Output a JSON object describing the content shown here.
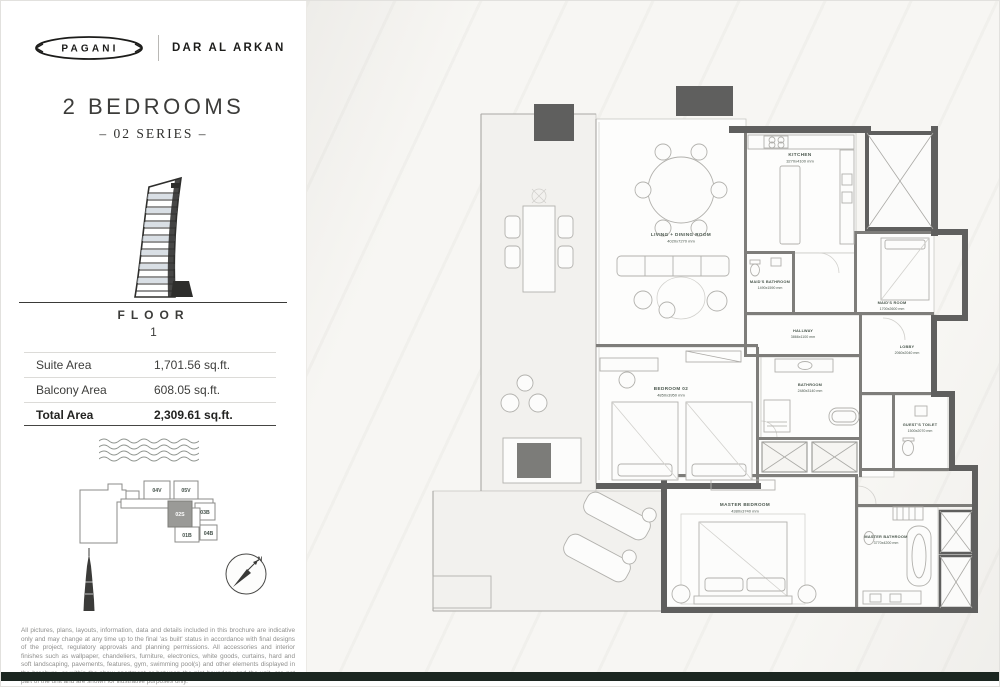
{
  "brand": {
    "logo": "PAGANI",
    "partner": "DAR AL ARKAN"
  },
  "header": {
    "title": "2 BEDROOMS",
    "subtitle": "– 02 SERIES –"
  },
  "floor": {
    "label": "FLOOR",
    "number": "1"
  },
  "areas": {
    "rows": [
      {
        "label": "Suite Area",
        "value": "1,701.56 sq.ft."
      },
      {
        "label": "Balcony Area",
        "value": "608.05 sq.ft."
      },
      {
        "label": "Total Area",
        "value": "2,309.61 sq.ft."
      }
    ]
  },
  "site_plan": {
    "units": {
      "u04v": "04V",
      "u05v": "05V",
      "u03b": "03B",
      "u01b": "01B",
      "u04b": "04B",
      "highlighted": "02S"
    }
  },
  "compass": {
    "north": "N"
  },
  "floor_plan": {
    "rooms": {
      "living": {
        "name": "LIVING + DINING ROOM",
        "dims": "4020x7270 mm"
      },
      "kitchen": {
        "name": "KITCHEN",
        "dims": "3270x4100 mm"
      },
      "maids_bathroom": {
        "name": "MAID'S BATHROOM",
        "dims": "1490x1590 mm"
      },
      "maids_room": {
        "name": "MAID'S ROOM",
        "dims": "1700x2600 mm"
      },
      "hallway": {
        "name": "HALLWAY",
        "dims": "3866x1100 mm"
      },
      "lobby": {
        "name": "LOBBY",
        "dims": "2060x2040 mm"
      },
      "bedroom_02": {
        "name": "BEDROOM 02",
        "dims": "4850x3950 mm"
      },
      "bathroom": {
        "name": "BATHROOM",
        "dims": "2480x3140 mm"
      },
      "guest_toilet": {
        "name": "GUEST'S TOILET",
        "dims": "1500x2070 mm"
      },
      "master_bedroom": {
        "name": "MASTER BEDROOM",
        "dims": "4380x3740 mm"
      },
      "master_bathroom": {
        "name": "MASTER BATHROOM",
        "dims": "3770x4200 mm"
      }
    }
  },
  "disclaimer": "All pictures, plans, layouts, information, data and details included in this brochure are indicative only and may change at any time up to the final 'as built' status in accordance with final designs of the project, regulatory approvals and planning permissions. All accessories and interior finishes such as wallpaper, chandeliers, furniture, electronics, white goods, curtains, hard and soft landscaping, pavements, features, gym, swimming pool(s) and other elements displayed in the brochure, or within the show apartment or between the plot boundary and the unit, are not part of the unit and are shown for illustrative purposes only.",
  "colors": {
    "accent": "#49564c",
    "wall": "#5f5f5e",
    "footer": "#1b2620"
  }
}
